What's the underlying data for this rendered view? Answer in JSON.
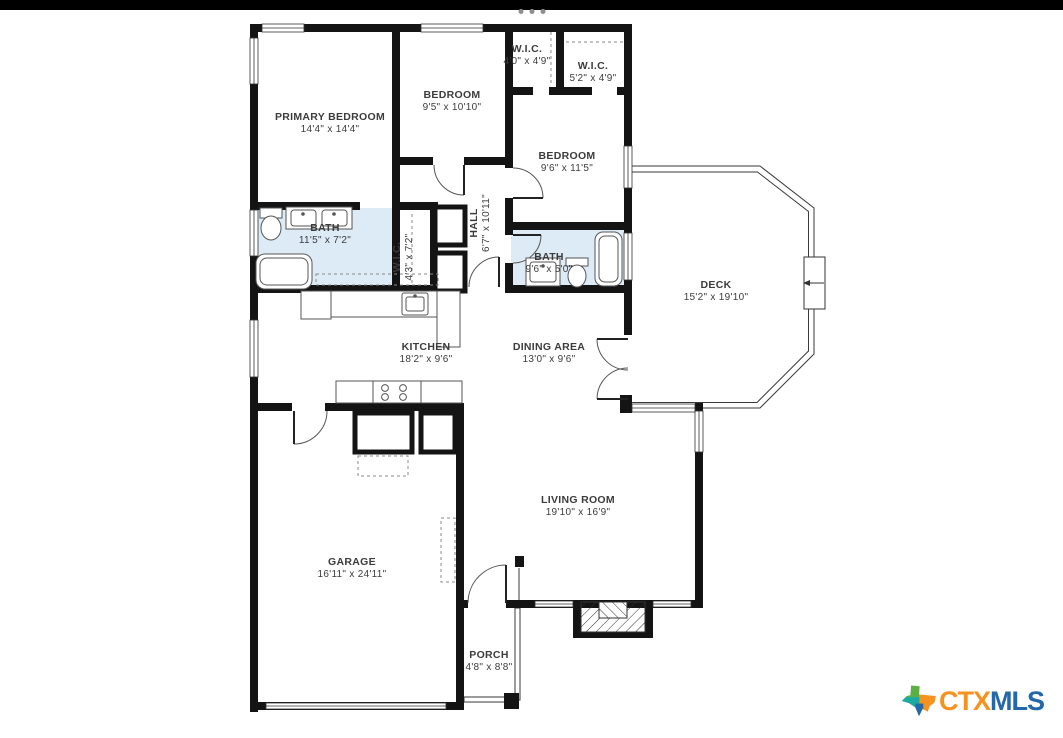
{
  "viewer": {
    "top_bar_color": "#000000",
    "carousel_dot_count": 3,
    "carousel_dot_color": "#8f8f8f"
  },
  "floor_plan": {
    "wall_color": "#141414",
    "bath_fill_color": "#dcebf5",
    "rooms": [
      {
        "name": "PRIMARY BEDROOM",
        "dims": "14'4\" x 14'4\""
      },
      {
        "name": "BEDROOM",
        "dims": "9'5\" x 10'10\""
      },
      {
        "name": "W.I.C.",
        "dims": "4'0\" x 4'9\""
      },
      {
        "name": "W.I.C.",
        "dims": "5'2\" x 4'9\""
      },
      {
        "name": "BEDROOM",
        "dims": "9'6\" x 11'5\""
      },
      {
        "name": "BATH",
        "dims": "11'5\" x 7'2\""
      },
      {
        "name": "W.I.C.",
        "dims": "4'3\" x 7'2\"",
        "orientation": "vertical"
      },
      {
        "name": "HALL",
        "dims": "6'7\" x 10'11\"",
        "orientation": "vertical"
      },
      {
        "name": "BATH",
        "dims": "9'6\" x 5'0\""
      },
      {
        "name": "DECK",
        "dims": "15'2\" x 19'10\""
      },
      {
        "name": "KITCHEN",
        "dims": "18'2\" x 9'6\""
      },
      {
        "name": "DINING AREA",
        "dims": "13'0\" x 9'6\""
      },
      {
        "name": "LIVING ROOM",
        "dims": "19'10\" x 16'9\""
      },
      {
        "name": "GARAGE",
        "dims": "16'11\" x 24'11\""
      },
      {
        "name": "PORCH",
        "dims": "4'8\" x 8'8\""
      }
    ]
  },
  "branding": {
    "ctx": "CTX",
    "mls": "MLS",
    "ctx_color": "#F6921E",
    "mls_color": "#2368A8",
    "texas_icon_colors": [
      "#5BB045",
      "#F6921E",
      "#1BA9A1",
      "#2368A8"
    ]
  }
}
